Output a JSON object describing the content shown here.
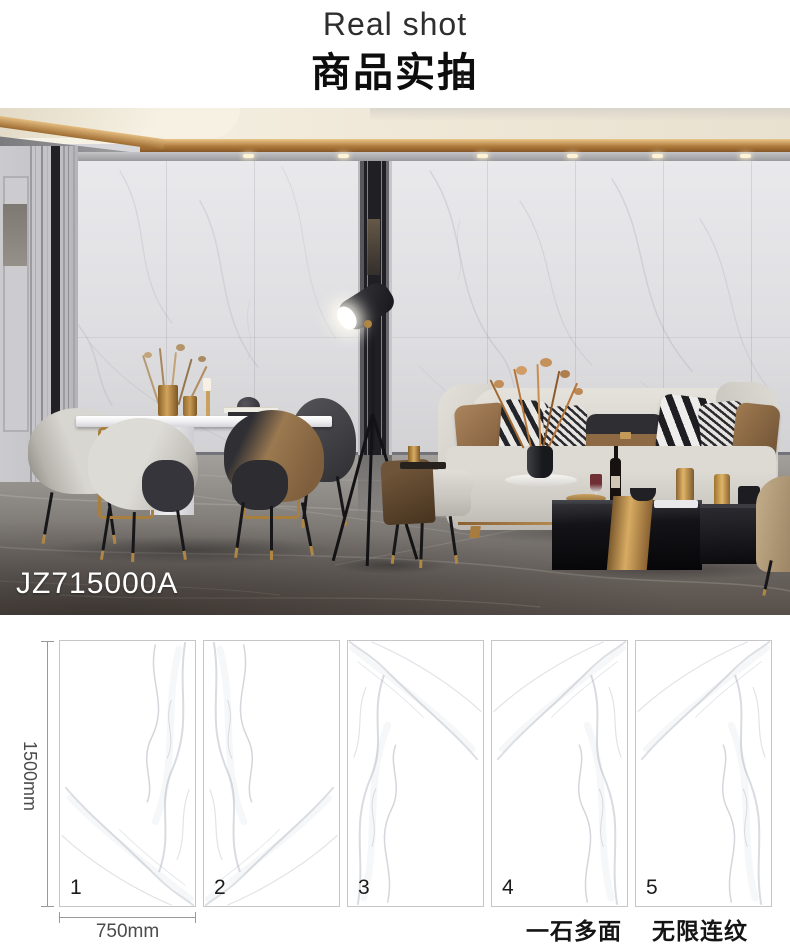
{
  "header": {
    "subtitle_en": "Real shot",
    "title_zh": "商品实拍",
    "plus": "+"
  },
  "photo": {
    "product_code": "JZ715000A"
  },
  "spec": {
    "height_label": "1500mm",
    "width_label": "750mm",
    "tiles": [
      {
        "number": "1"
      },
      {
        "number": "2"
      },
      {
        "number": "3"
      },
      {
        "number": "4"
      },
      {
        "number": "5"
      }
    ],
    "tagline_left": "一石多面",
    "tagline_right": "无限连纹"
  },
  "colors": {
    "accent_gold": "#b08644",
    "led_amber": "#c99a5a",
    "marble_white": "#ffffff",
    "floor_dark": "#57504a",
    "text_black": "#0d0d0d"
  }
}
